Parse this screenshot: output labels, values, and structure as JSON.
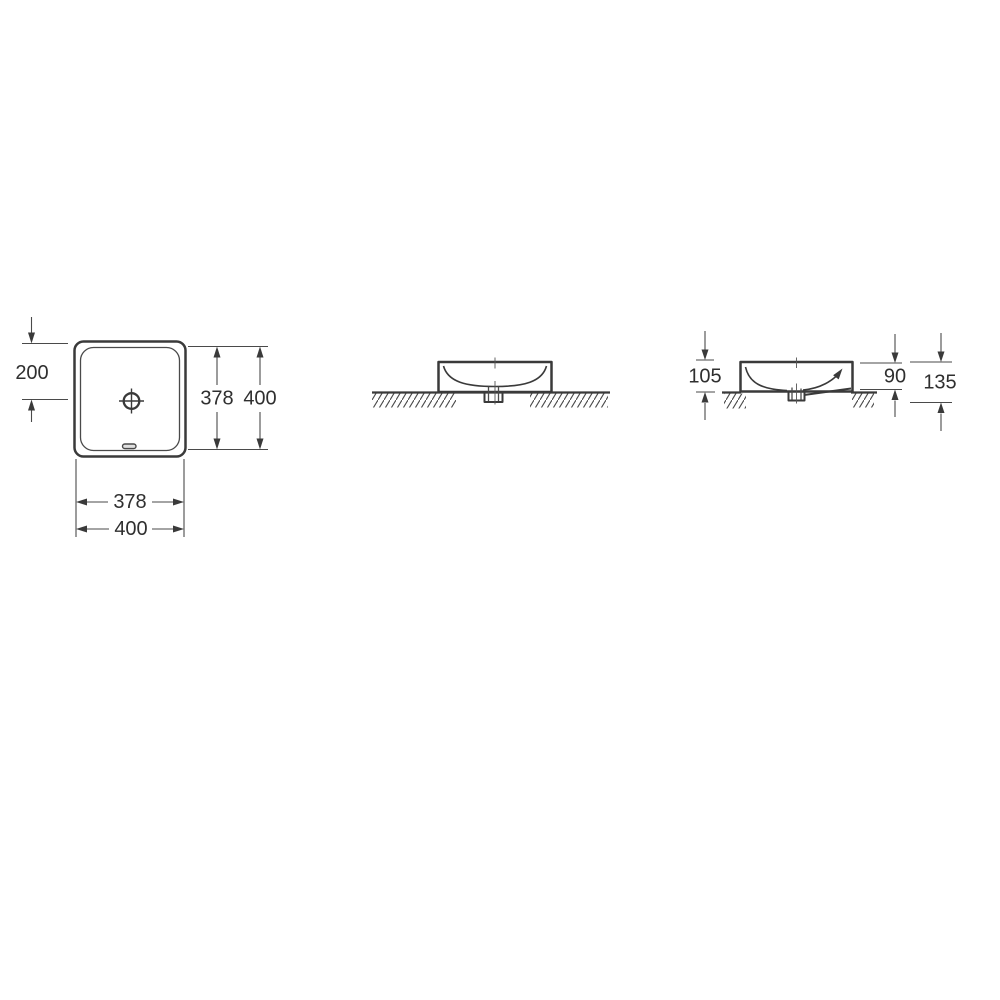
{
  "page": {
    "background_color": "#ffffff",
    "line_color": "#3a3a3a",
    "dim_line_color": "#4a4a4a",
    "text_color": "#2f2f2f"
  },
  "drawing": {
    "views": {
      "top_view": {
        "dims": {
          "edge_to_drain": "200",
          "inner_height": "378",
          "outer_height": "400",
          "inner_width": "378",
          "outer_width": "400"
        }
      },
      "front_view": {},
      "side_view": {
        "dims": {
          "height_above_counter": "105",
          "basin_depth": "90",
          "total_height": "135"
        }
      }
    }
  }
}
